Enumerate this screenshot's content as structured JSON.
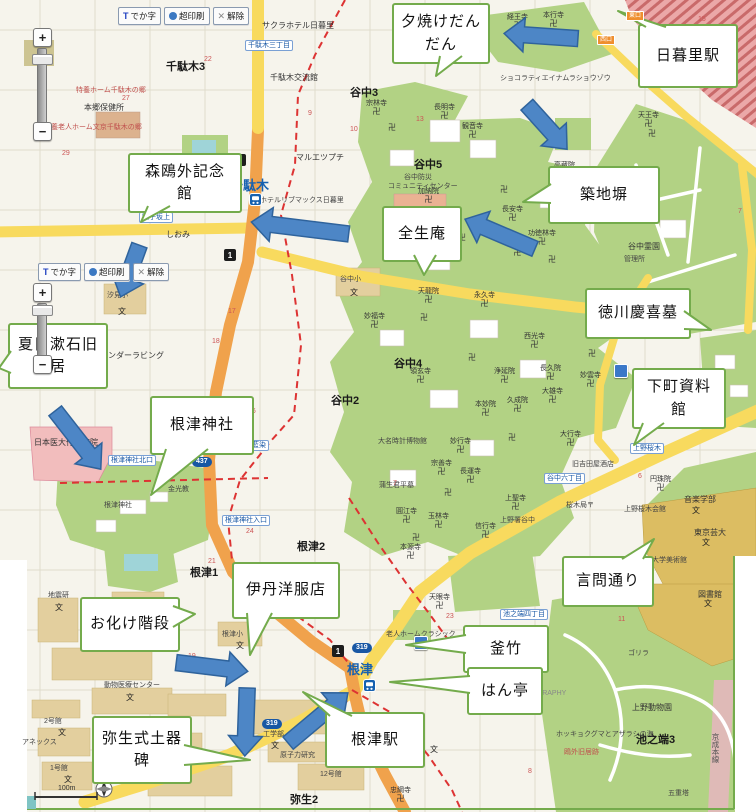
{
  "colors": {
    "base": "#f6f4ec",
    "grid": "#ddd9c8",
    "green": "#b2d284",
    "tan": "#e3cf9e",
    "campus_tan": "#dcbd62",
    "pink": "#f2bdbd",
    "water": "#9fd4d8",
    "road_yellow": "#f8da5e",
    "road_orange": "#f0a24c",
    "boundary": "#dd3333",
    "rail_bg": "#eba8a8",
    "rail_red": "#c96a6a",
    "keisei_pink": "#eab4c4",
    "callout_border": "#74ab4c",
    "arrow_fill": "#4d86c6",
    "arrow_stroke": "#2f639c",
    "busstop_blue": "#1857a4",
    "station_blue": "#1661b0"
  },
  "toolbars": [
    {
      "x": 118,
      "y": 7,
      "buttons": [
        {
          "id": "dekaji-button",
          "icon": "t-icon",
          "label": "でか字"
        },
        {
          "id": "print-button",
          "icon": "printer-icon",
          "label": "超印刷"
        },
        {
          "id": "clear-button",
          "icon": "close-icon",
          "label": "解除"
        }
      ]
    },
    {
      "x": 38,
      "y": 263,
      "buttons": [
        {
          "id": "dekaji-button",
          "icon": "t-icon",
          "label": "でか字"
        },
        {
          "id": "print-button",
          "icon": "printer-icon",
          "label": "超印刷"
        },
        {
          "id": "clear-button",
          "icon": "close-icon",
          "label": "解除"
        }
      ]
    }
  ],
  "zoom_sliders": [
    {
      "x": 33,
      "plus_y": 28,
      "track_top": 48,
      "track_bottom": 122,
      "handle_y": 54,
      "minus_y": 122
    },
    {
      "x": 33,
      "plus_y": 283,
      "track_top": 303,
      "track_bottom": 355,
      "handle_y": 305,
      "minus_y": 355
    }
  ],
  "zoom_plus_label": "+",
  "zoom_minus_label": "−",
  "scale": {
    "label": "100m"
  },
  "station_tags": [
    {
      "t": "東口",
      "x": 626,
      "y": 11
    },
    {
      "t": "西口",
      "x": 597,
      "y": 35
    }
  ],
  "callouts": [
    {
      "id": "yuyake-dandan",
      "lines": [
        "夕焼けだん",
        "だん"
      ],
      "x": 392,
      "y": 3,
      "w": 94,
      "h": 57,
      "ptr": [
        [
          440,
          56
        ],
        [
          436,
          76
        ],
        [
          462,
          56
        ]
      ]
    },
    {
      "id": "nippori-station",
      "lines": [
        "日暮里駅"
      ],
      "x": 638,
      "y": 24,
      "w": 96,
      "h": 60,
      "ptr": [
        [
          646,
          27
        ],
        [
          618,
          11
        ],
        [
          666,
          27
        ]
      ]
    },
    {
      "id": "mori-ogai",
      "lines": [
        "森鴎外記念",
        "館"
      ],
      "x": 128,
      "y": 153,
      "w": 110,
      "h": 56,
      "ptr": [
        [
          148,
          206
        ],
        [
          141,
          222
        ],
        [
          170,
          206
        ]
      ]
    },
    {
      "id": "tsukiji-bei",
      "lines": [
        "築地塀"
      ],
      "x": 548,
      "y": 166,
      "w": 108,
      "h": 54,
      "ptr": [
        [
          551,
          184
        ],
        [
          523,
          202
        ],
        [
          551,
          203
        ]
      ]
    },
    {
      "id": "zensho-an",
      "lines": [
        "全生庵"
      ],
      "x": 382,
      "y": 206,
      "w": 76,
      "h": 52,
      "ptr": [
        [
          414,
          255
        ],
        [
          424,
          275
        ],
        [
          436,
          255
        ]
      ]
    },
    {
      "id": "tokugawa-grave",
      "lines": [
        "徳川慶喜墓"
      ],
      "x": 585,
      "y": 288,
      "w": 102,
      "h": 47,
      "ptr": [
        [
          684,
          311
        ],
        [
          711,
          330
        ],
        [
          684,
          329
        ]
      ]
    },
    {
      "id": "shitamachi",
      "lines": [
        "下町資料",
        "館"
      ],
      "x": 632,
      "y": 368,
      "w": 90,
      "h": 57,
      "ptr": [
        [
          643,
          423
        ],
        [
          634,
          445
        ],
        [
          664,
          423
        ]
      ]
    },
    {
      "id": "natsume-soseki",
      "lines": [
        "夏目漱石旧",
        "居"
      ],
      "x": 8,
      "y": 323,
      "w": 96,
      "h": 62,
      "ptr": [
        [
          11,
          351
        ],
        [
          -1,
          368
        ],
        [
          11,
          373
        ]
      ]
    },
    {
      "id": "nezu-jinja",
      "lines": [
        "根津神社"
      ],
      "x": 150,
      "y": 396,
      "w": 100,
      "h": 55,
      "ptr": [
        [
          166,
          449
        ],
        [
          151,
          495
        ],
        [
          208,
          449
        ]
      ]
    },
    {
      "id": "kototoi-dori",
      "lines": [
        "言問通り"
      ],
      "x": 562,
      "y": 556,
      "w": 88,
      "h": 47,
      "ptr": [
        [
          622,
          559
        ],
        [
          654,
          539
        ],
        [
          643,
          559
        ]
      ]
    },
    {
      "id": "itami-yofukuten",
      "lines": [
        "伊丹洋服店"
      ],
      "x": 232,
      "y": 562,
      "w": 104,
      "h": 53,
      "ptr": [
        [
          247,
          613
        ],
        [
          250,
          655
        ],
        [
          272,
          613
        ]
      ]
    },
    {
      "id": "obake-kaidan",
      "lines": [
        "お化け階段"
      ],
      "x": 80,
      "y": 597,
      "w": 96,
      "h": 51,
      "ptr": [
        [
          173,
          606
        ],
        [
          195,
          614
        ],
        [
          173,
          627
        ]
      ]
    },
    {
      "id": "kamachiku",
      "lines": [
        "釜竹"
      ],
      "x": 463,
      "y": 625,
      "w": 82,
      "h": 44,
      "ptr": [
        [
          466,
          635
        ],
        [
          406,
          645
        ],
        [
          466,
          653
        ]
      ]
    },
    {
      "id": "hantei",
      "lines": [
        "はん亭"
      ],
      "x": 467,
      "y": 667,
      "w": 72,
      "h": 44,
      "ptr": [
        [
          470,
          676
        ],
        [
          390,
          682
        ],
        [
          470,
          693
        ]
      ]
    },
    {
      "id": "yayoi-doki-hi",
      "lines": [
        "弥生式土器",
        "碑"
      ],
      "x": 92,
      "y": 716,
      "w": 96,
      "h": 64,
      "ptr": [
        [
          184,
          745
        ],
        [
          250,
          760
        ],
        [
          184,
          765
        ]
      ]
    },
    {
      "id": "nezu-station",
      "lines": [
        "根津駅"
      ],
      "x": 325,
      "y": 712,
      "w": 96,
      "h": 52,
      "ptr": [
        [
          330,
          716
        ],
        [
          303,
          692
        ],
        [
          352,
          716
        ]
      ]
    }
  ],
  "arrows": [
    {
      "cx": 541,
      "cy": 36,
      "len": 74,
      "rot": 184
    },
    {
      "cx": 547,
      "cy": 127,
      "len": 60,
      "rot": 48
    },
    {
      "cx": 300,
      "cy": 228,
      "len": 98,
      "rot": 187
    },
    {
      "cx": 500,
      "cy": 234,
      "len": 76,
      "rot": 203
    },
    {
      "cx": 130,
      "cy": 271,
      "len": 55,
      "rot": 110
    },
    {
      "cx": 78,
      "cy": 440,
      "len": 74,
      "rot": 52
    },
    {
      "cx": 212,
      "cy": 667,
      "len": 72,
      "rot": 7
    },
    {
      "cx": 246,
      "cy": 722,
      "len": 68,
      "rot": 92
    },
    {
      "cx": 318,
      "cy": 718,
      "len": 78,
      "rot": -40
    }
  ],
  "map_labels": [
    {
      "t": "千駄木3",
      "x": 166,
      "y": 58,
      "c": "area"
    },
    {
      "t": "谷中3",
      "x": 350,
      "y": 84,
      "c": "area"
    },
    {
      "t": "谷中5",
      "x": 414,
      "y": 156,
      "c": "area"
    },
    {
      "t": "谷中2",
      "x": 331,
      "y": 392,
      "c": "area"
    },
    {
      "t": "谷中4",
      "x": 394,
      "y": 355,
      "c": "area"
    },
    {
      "t": "根津2",
      "x": 297,
      "y": 538,
      "c": "area"
    },
    {
      "t": "根津1",
      "x": 190,
      "y": 564,
      "c": "area"
    },
    {
      "t": "弥生2",
      "x": 290,
      "y": 791,
      "c": "area"
    },
    {
      "t": "池之端3",
      "x": 636,
      "y": 731,
      "c": "area"
    },
    {
      "t": "サクラホテル日暮里",
      "x": 262,
      "y": 20,
      "c": "poi"
    },
    {
      "t": "千駄木交流館",
      "x": 270,
      "y": 72,
      "c": "poi"
    },
    {
      "t": "本郷保健所",
      "x": 84,
      "y": 102,
      "c": "poi"
    },
    {
      "t": "マルエツプチ",
      "x": 296,
      "y": 152,
      "c": "poi"
    },
    {
      "t": "ホテルリブマックス日暮里",
      "x": 260,
      "y": 195,
      "c": "tiny"
    },
    {
      "t": "しおみ",
      "x": 166,
      "y": 229,
      "c": "poi"
    },
    {
      "t": "テンダーラビング",
      "x": 100,
      "y": 350,
      "c": "poi"
    },
    {
      "t": "汐見小",
      "x": 107,
      "y": 290,
      "c": "tiny"
    },
    {
      "t": "根津小",
      "x": 222,
      "y": 629,
      "c": "tiny"
    },
    {
      "t": "谷中小",
      "x": 340,
      "y": 274,
      "c": "tiny"
    },
    {
      "t": "日本医大付属病院",
      "x": 34,
      "y": 437,
      "c": "poi"
    },
    {
      "t": "金光教",
      "x": 168,
      "y": 484,
      "c": "tiny"
    },
    {
      "t": "根津神社",
      "x": 104,
      "y": 500,
      "c": "tiny"
    },
    {
      "t": "大名時計博物館",
      "x": 378,
      "y": 436,
      "c": "tiny"
    },
    {
      "t": "蒲生君平墓",
      "x": 379,
      "y": 480,
      "c": "tiny"
    },
    {
      "t": "上野署谷中",
      "x": 500,
      "y": 515,
      "c": "tiny"
    },
    {
      "t": "老人ホームクラシック",
      "x": 386,
      "y": 629,
      "c": "tiny"
    },
    {
      "t": "谷中防災",
      "x": 404,
      "y": 172,
      "c": "tiny"
    },
    {
      "t": "コミュニティセンター",
      "x": 388,
      "y": 181,
      "c": "tiny"
    },
    {
      "t": "ショコラティエイナムラショウゾウ",
      "x": 500,
      "y": 73,
      "c": "tiny"
    },
    {
      "t": "谷中霊園",
      "x": 628,
      "y": 241,
      "c": "poi"
    },
    {
      "t": "管理所",
      "x": 624,
      "y": 254,
      "c": "tiny"
    },
    {
      "t": "上野桜木会館",
      "x": 624,
      "y": 504,
      "c": "tiny"
    },
    {
      "t": "旧吉田屋酒店",
      "x": 572,
      "y": 459,
      "c": "tiny"
    },
    {
      "t": "桜木局〒",
      "x": 566,
      "y": 500,
      "c": "tiny"
    },
    {
      "t": "音楽学部",
      "x": 684,
      "y": 494,
      "c": "poi"
    },
    {
      "t": "東京芸大",
      "x": 694,
      "y": 527,
      "c": "poi"
    },
    {
      "t": "大学美術館",
      "x": 652,
      "y": 555,
      "c": "tiny"
    },
    {
      "t": "図書館",
      "x": 698,
      "y": 589,
      "c": "poi"
    },
    {
      "t": "ゴリラ",
      "x": 628,
      "y": 648,
      "c": "tiny"
    },
    {
      "t": "上野動物園",
      "x": 632,
      "y": 702,
      "c": "poi"
    },
    {
      "t": "ホッキョクグマとアザラシの海",
      "x": 556,
      "y": 729,
      "c": "tiny"
    },
    {
      "t": "五重塔",
      "x": 668,
      "y": 788,
      "c": "tiny"
    },
    {
      "t": "地震研",
      "x": 48,
      "y": 590,
      "c": "tiny"
    },
    {
      "t": "動物医療センター",
      "x": 104,
      "y": 680,
      "c": "tiny"
    },
    {
      "t": "2号館",
      "x": 44,
      "y": 716,
      "c": "tiny"
    },
    {
      "t": "アネックス",
      "x": 22,
      "y": 737,
      "c": "tiny"
    },
    {
      "t": "1号館",
      "x": 50,
      "y": 763,
      "c": "tiny"
    },
    {
      "t": "工学部",
      "x": 263,
      "y": 729,
      "c": "tiny"
    },
    {
      "t": "原子力研究",
      "x": 280,
      "y": 750,
      "c": "tiny"
    },
    {
      "t": "12号館",
      "x": 320,
      "y": 769,
      "c": "tiny"
    },
    {
      "t": "京成本線",
      "x": 710,
      "y": 733,
      "c": "vert"
    },
    {
      "t": "PHOTOGRAPHY",
      "x": 512,
      "y": 690,
      "c": "eng"
    },
    {
      "t": "鴎外旧居跡",
      "x": 564,
      "y": 747,
      "c": "red"
    },
    {
      "t": "特養ホーム千駄木の郷",
      "x": 76,
      "y": 85,
      "c": "red"
    },
    {
      "t": "特養老人ホーム文京千駄木の郷",
      "x": 44,
      "y": 122,
      "c": "red"
    },
    {
      "t": "27",
      "x": 122,
      "y": 95,
      "c": "num"
    },
    {
      "t": "29",
      "x": 62,
      "y": 150,
      "c": "num"
    },
    {
      "t": "22",
      "x": 204,
      "y": 56,
      "c": "num"
    },
    {
      "t": "14",
      "x": 418,
      "y": 6,
      "c": "num"
    },
    {
      "t": "13",
      "x": 416,
      "y": 116,
      "c": "num"
    },
    {
      "t": "9",
      "x": 308,
      "y": 110,
      "c": "num"
    },
    {
      "t": "10",
      "x": 350,
      "y": 126,
      "c": "num"
    },
    {
      "t": "17",
      "x": 228,
      "y": 308,
      "c": "num"
    },
    {
      "t": "18",
      "x": 212,
      "y": 338,
      "c": "num"
    },
    {
      "t": "46",
      "x": 248,
      "y": 408,
      "c": "num"
    },
    {
      "t": "24",
      "x": 246,
      "y": 528,
      "c": "num"
    },
    {
      "t": "21",
      "x": 208,
      "y": 558,
      "c": "num"
    },
    {
      "t": "20",
      "x": 298,
      "y": 584,
      "c": "num"
    },
    {
      "t": "23",
      "x": 446,
      "y": 613,
      "c": "num"
    },
    {
      "t": "11",
      "x": 618,
      "y": 616,
      "c": "num"
    },
    {
      "t": "15",
      "x": 698,
      "y": 16,
      "c": "num"
    },
    {
      "t": "7",
      "x": 738,
      "y": 208,
      "c": "num"
    },
    {
      "t": "7",
      "x": 393,
      "y": 480,
      "c": "num"
    },
    {
      "t": "5",
      "x": 344,
      "y": 698,
      "c": "num"
    },
    {
      "t": "3",
      "x": 118,
      "y": 768,
      "c": "num"
    },
    {
      "t": "8",
      "x": 528,
      "y": 768,
      "c": "num"
    },
    {
      "t": "6",
      "x": 638,
      "y": 473,
      "c": "num"
    },
    {
      "t": "19",
      "x": 188,
      "y": 653,
      "c": "num"
    }
  ],
  "temples": [
    {
      "t": "経王寺",
      "x": 507,
      "y": 14
    },
    {
      "t": "本行寺",
      "x": 543,
      "y": 12
    },
    {
      "t": "天王寺",
      "x": 638,
      "y": 112
    },
    {
      "t": "宗林寺",
      "x": 366,
      "y": 100
    },
    {
      "t": "長明寺",
      "x": 434,
      "y": 104
    },
    {
      "t": "観音寺",
      "x": 462,
      "y": 123
    },
    {
      "t": "加納院",
      "x": 418,
      "y": 188
    },
    {
      "t": "長安寺",
      "x": 502,
      "y": 206
    },
    {
      "t": "高蔵院",
      "x": 554,
      "y": 162
    },
    {
      "t": "功徳林寺",
      "x": 528,
      "y": 230
    },
    {
      "t": "常在寺",
      "x": 507,
      "y": 241
    },
    {
      "t": "天龍院",
      "x": 418,
      "y": 288
    },
    {
      "t": "永久寺",
      "x": 474,
      "y": 292
    },
    {
      "t": "妙福寺",
      "x": 364,
      "y": 313
    },
    {
      "t": "領玄寺",
      "x": 410,
      "y": 368
    },
    {
      "t": "西光寺",
      "x": 524,
      "y": 333
    },
    {
      "t": "長久院",
      "x": 540,
      "y": 365
    },
    {
      "t": "浄延院",
      "x": 494,
      "y": 368
    },
    {
      "t": "大雄寺",
      "x": 542,
      "y": 388
    },
    {
      "t": "久成院",
      "x": 507,
      "y": 397
    },
    {
      "t": "本妙院",
      "x": 475,
      "y": 401
    },
    {
      "t": "妙行寺",
      "x": 450,
      "y": 438
    },
    {
      "t": "宗善寺",
      "x": 431,
      "y": 460
    },
    {
      "t": "長運寺",
      "x": 460,
      "y": 468
    },
    {
      "t": "上聖寺",
      "x": 505,
      "y": 495
    },
    {
      "t": "信行寺",
      "x": 475,
      "y": 523
    },
    {
      "t": "玉林寺",
      "x": 428,
      "y": 513
    },
    {
      "t": "圓江寺",
      "x": 396,
      "y": 508
    },
    {
      "t": "本源寺",
      "x": 400,
      "y": 544
    },
    {
      "t": "妙雲寺",
      "x": 580,
      "y": 372
    },
    {
      "t": "大行寺",
      "x": 560,
      "y": 431
    },
    {
      "t": "円珠院",
      "x": 650,
      "y": 476
    },
    {
      "t": "天眼寺",
      "x": 429,
      "y": 594
    },
    {
      "t": "忠綱寺",
      "x": 390,
      "y": 787
    }
  ],
  "manji_marks": [
    {
      "x": 388,
      "y": 122
    },
    {
      "x": 500,
      "y": 184
    },
    {
      "x": 548,
      "y": 254
    },
    {
      "x": 458,
      "y": 232
    },
    {
      "x": 420,
      "y": 312
    },
    {
      "x": 468,
      "y": 352
    },
    {
      "x": 508,
      "y": 432
    },
    {
      "x": 444,
      "y": 487
    },
    {
      "x": 412,
      "y": 532
    },
    {
      "x": 588,
      "y": 348
    },
    {
      "x": 648,
      "y": 128
    }
  ],
  "school_marks": [
    {
      "x": 118,
      "y": 306
    },
    {
      "x": 350,
      "y": 287
    },
    {
      "x": 236,
      "y": 640
    },
    {
      "x": 702,
      "y": 537
    },
    {
      "x": 692,
      "y": 505
    },
    {
      "x": 430,
      "y": 744
    },
    {
      "x": 55,
      "y": 602
    },
    {
      "x": 126,
      "y": 692
    },
    {
      "x": 58,
      "y": 727
    },
    {
      "x": 64,
      "y": 774
    },
    {
      "x": 271,
      "y": 740
    },
    {
      "x": 704,
      "y": 598
    }
  ],
  "bus_stops": [
    {
      "t": "千駄木三丁目",
      "x": 245,
      "y": 40
    },
    {
      "t": "団子坂上",
      "x": 139,
      "y": 212
    },
    {
      "t": "根津神社北口",
      "x": 108,
      "y": 455
    },
    {
      "t": "根津神社入口",
      "x": 222,
      "y": 515
    },
    {
      "t": "藍染",
      "x": 249,
      "y": 440
    },
    {
      "t": "谷中六丁目",
      "x": 544,
      "y": 473
    },
    {
      "t": "上野桜木",
      "x": 630,
      "y": 443
    },
    {
      "t": "池之端四丁目",
      "x": 500,
      "y": 609
    }
  ],
  "stations": [
    {
      "t": "千駄木",
      "x": 230,
      "y": 175,
      "ix": 249,
      "iy": 193
    },
    {
      "t": "根津",
      "x": 347,
      "y": 659,
      "ix": 363,
      "iy": 679
    }
  ],
  "route_squares": [
    {
      "t": "2",
      "x": 234,
      "y": 154
    },
    {
      "t": "1",
      "x": 224,
      "y": 249
    },
    {
      "t": "1",
      "x": 332,
      "y": 645
    }
  ],
  "route_ovals": [
    {
      "t": "437",
      "x": 192,
      "y": 457
    },
    {
      "t": "319",
      "x": 352,
      "y": 643
    },
    {
      "t": "319",
      "x": 262,
      "y": 719
    }
  ],
  "photo_markers": [
    {
      "x": 614,
      "y": 364
    },
    {
      "x": 414,
      "y": 636
    }
  ]
}
